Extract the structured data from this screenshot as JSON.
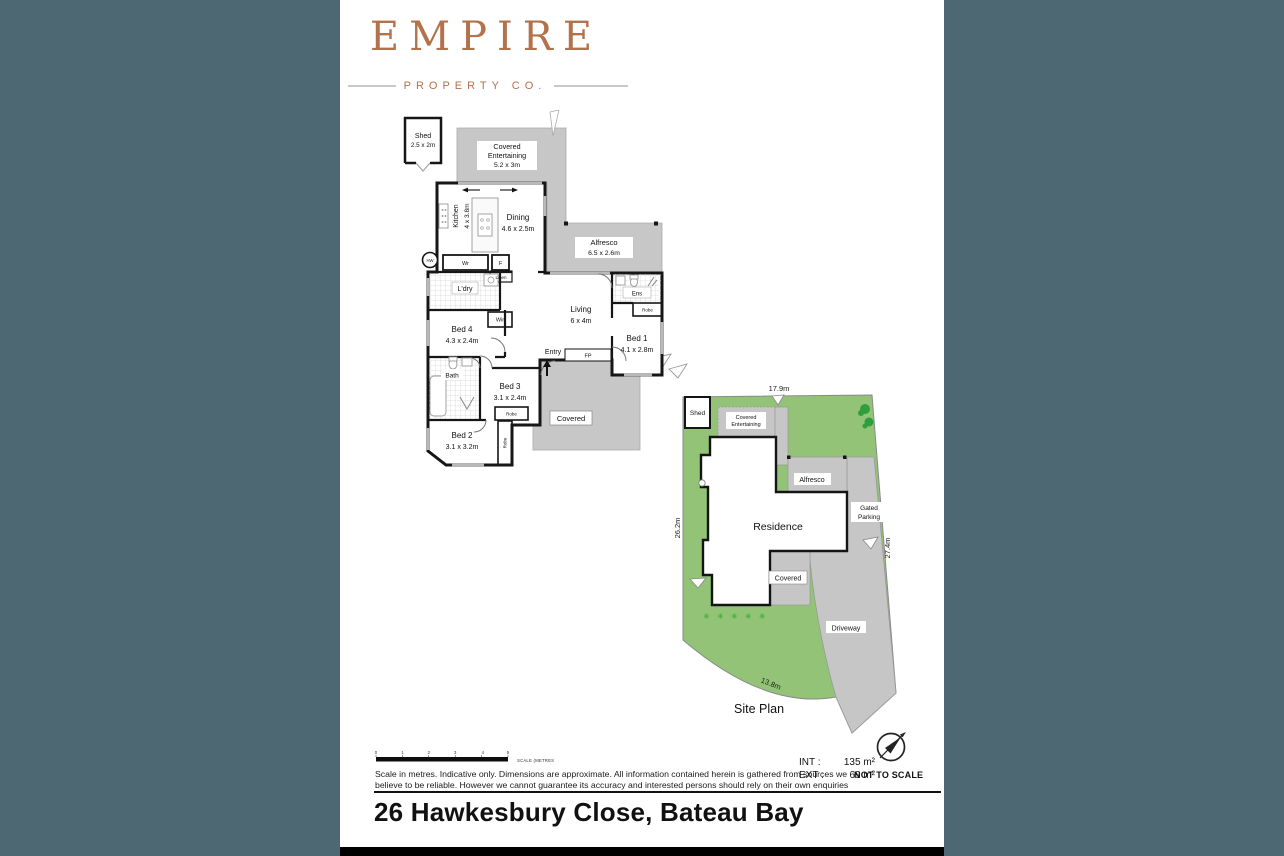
{
  "colors": {
    "background": "#4d6872",
    "paper": "#ffffff",
    "brand_copper": "#b3724c",
    "outdoor_gray": "#c7c7c7",
    "lawn_green": "#93c377",
    "tree_green": "#2f9e3c",
    "shrub_green": "#2aa22a"
  },
  "logo": {
    "brand": "EMPIRE",
    "tagline": "PROPERTY CO."
  },
  "floorplan": {
    "shed_name": "Shed",
    "shed_dims": "2.5 x 2m",
    "covent_1": "Covered",
    "covent_2": "Entertaining",
    "covent_dims": "5.2 x 3m",
    "kitchen": "Kitchen",
    "kitchen_dims": "4 x 3.8m",
    "dining": "Dining",
    "dining_dims": "4.6 x 2.5m",
    "alfresco": "Alfresco",
    "alfresco_dims": "6.5 x 2.6m",
    "laundry": "L'dry",
    "bed4": "Bed 4",
    "bed4_dims": "4.3 x 2.4m",
    "bath": "Bath",
    "bed2": "Bed 2",
    "bed2_dims": "3.1 x 3.2m",
    "bed3": "Bed 3",
    "bed3_dims": "3.1 x 2.4m",
    "living": "Living",
    "living_dims": "6 x 4m",
    "entry": "Entry",
    "bed1": "Bed 1",
    "bed1_dims": "4.1 x 2.8m",
    "ens": "Ens",
    "covered": "Covered",
    "hw": "HW",
    "wr": "Wr",
    "f": "F",
    "linen": "Linen",
    "wir": "Wir",
    "robe": "Robe",
    "fp": "FP"
  },
  "siteplan": {
    "title": "Site Plan",
    "shed": "Shed",
    "covent_1": "Covered",
    "covent_2": "Entertaining",
    "alfresco": "Alfresco",
    "gated_1": "Gated",
    "gated_2": "Parking",
    "residence": "Residence",
    "covered": "Covered",
    "driveway": "Driveway",
    "dim_top": "17.9m",
    "dim_left": "26.2m",
    "dim_right": "27.4m",
    "dim_front": "13.8m",
    "shrubs": "✳ ✳ ✳ ✳ ✳"
  },
  "footer": {
    "scale_ticks": [
      "0",
      "1",
      "2",
      "3",
      "4",
      "5"
    ],
    "scale_caption": "SCALE (METRES)",
    "disclaimer1": "Scale in metres. Indicative only. Dimensions are approximate. All information contained herein is gathered from sources we",
    "disclaimer2": "believe to be reliable. However we cannot guarantee its accuracy and interested persons should rely on their own enquiries",
    "int_label": "INT :",
    "int_value": "135 m²",
    "ext_label": "EXT :",
    "ext_value": "69 m²",
    "not_to_scale": "NOT TO SCALE",
    "address": "26 Hawkesbury Close, Bateau Bay"
  }
}
